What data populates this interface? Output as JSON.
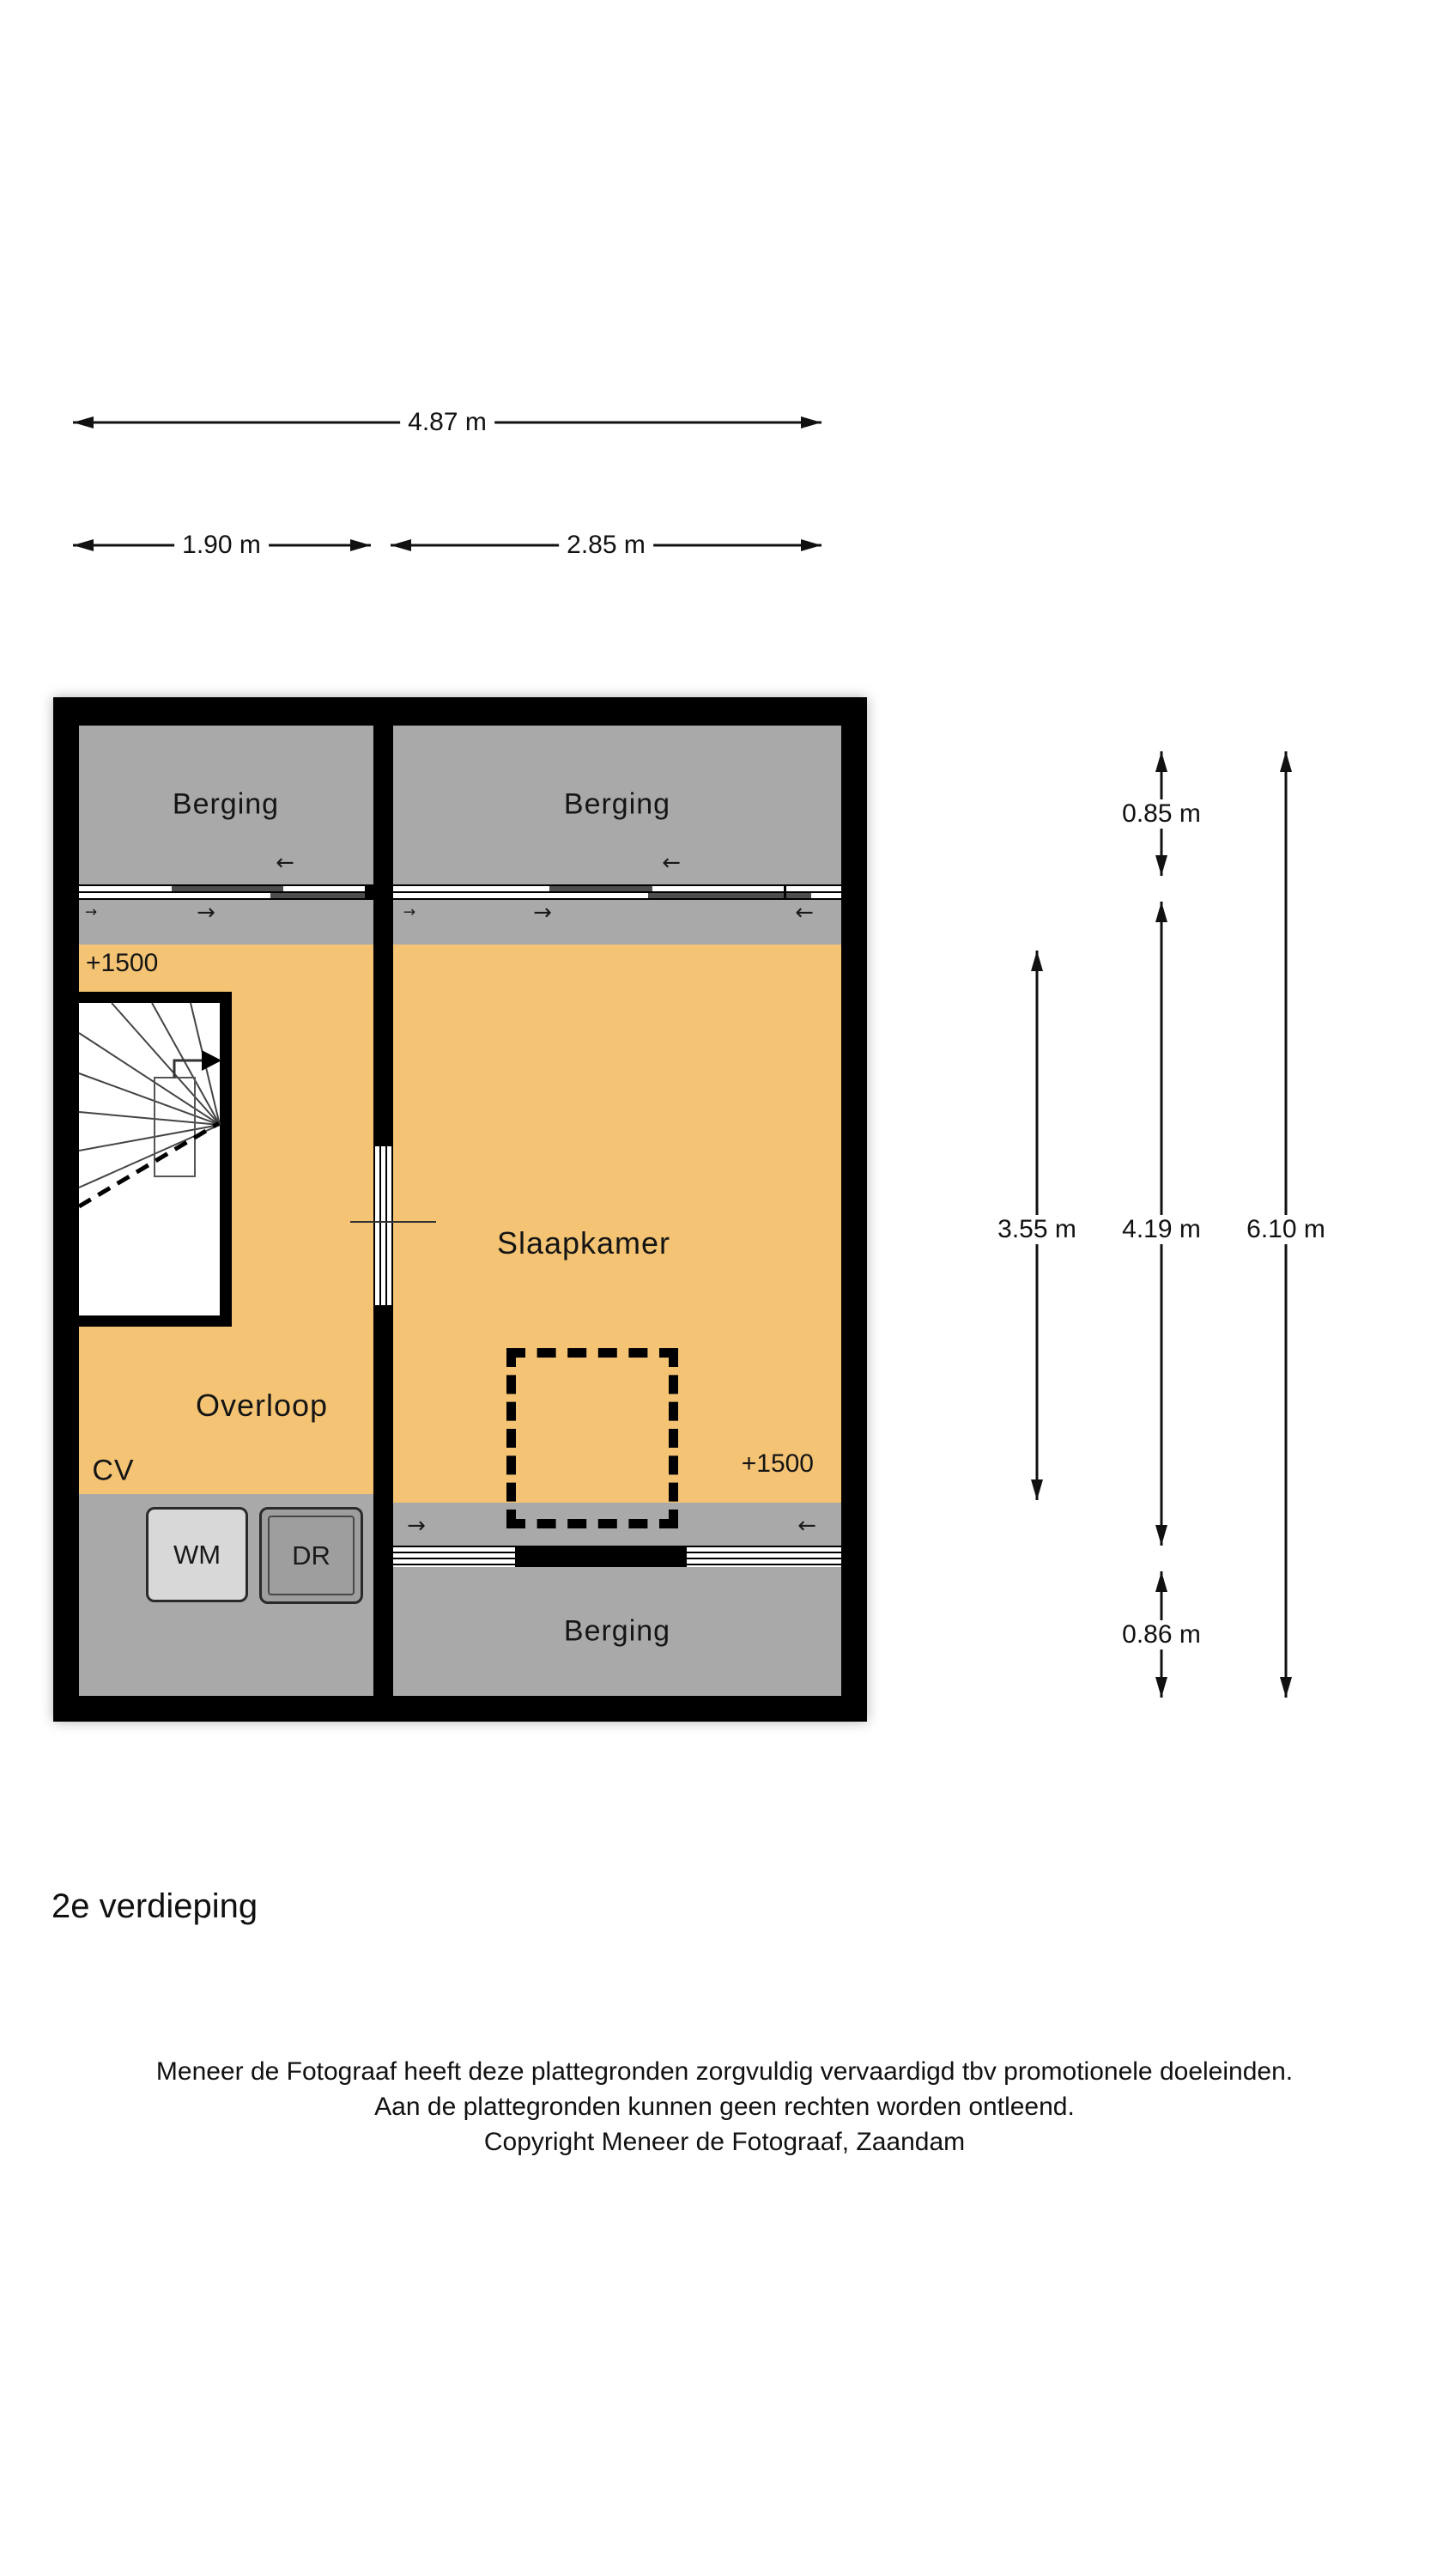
{
  "floorplan": {
    "title": "2e verdieping",
    "rooms": {
      "berging_top_left": "Berging",
      "berging_top_right": "Berging",
      "berging_bottom": "Berging",
      "slaapkamer": "Slaapkamer",
      "overloop": "Overloop",
      "cv": "CV"
    },
    "appliances": {
      "wm": "WM",
      "dr": "DR"
    },
    "level_markers": {
      "left": "+1500",
      "right": "+1500"
    },
    "dimensions": {
      "width_total": "4.87 m",
      "width_left": "1.90 m",
      "width_right": "2.85 m",
      "height_top": "0.85 m",
      "height_left": "3.55 m",
      "height_mid": "4.19 m",
      "height_total": "6.10 m",
      "height_bottom": "0.86 m"
    },
    "icons": {
      "arrow_left": "←",
      "arrow_right": "→"
    },
    "colors": {
      "floor_orange": "#f4c474",
      "room_gray": "#a9a9a9",
      "wall_black": "#000000",
      "appliance_light": "#d8d8d8",
      "appliance_dark": "#9e9e9e"
    }
  },
  "footer": {
    "line1": "Meneer de Fotograaf heeft deze plattegronden zorgvuldig vervaardigd tbv promotionele doeleinden.",
    "line2": "Aan de plattegronden kunnen geen rechten worden ontleend.",
    "line3": "Copyright Meneer de Fotograaf, Zaandam"
  }
}
